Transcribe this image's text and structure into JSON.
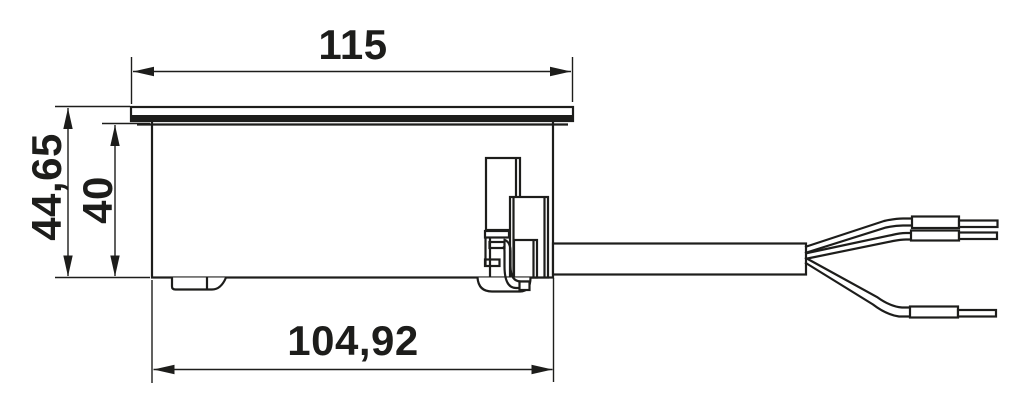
{
  "drawing": {
    "type": "technical-dimension-drawing",
    "subject": "recessed socket housing side view with lid, latch, mounting feet and 3-wire power cable",
    "colors": {
      "background": "#ffffff",
      "line": "#1d1d1b",
      "text": "#1d1d1b"
    },
    "dimensions": {
      "top_width": "115",
      "overall_height": "44,65",
      "housing_height": "40",
      "bottom_width": "104,92"
    }
  }
}
